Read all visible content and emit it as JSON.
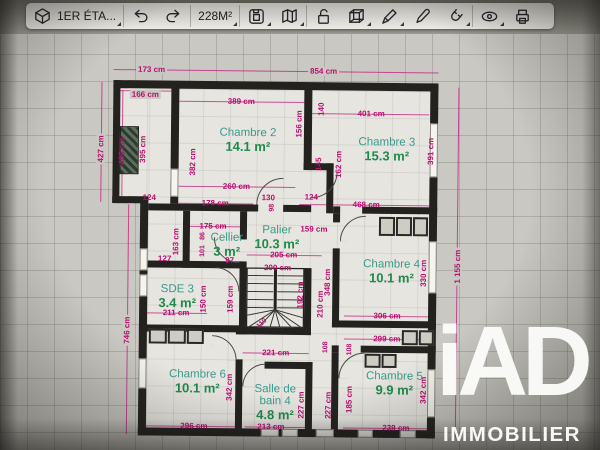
{
  "toolbar": {
    "floor_selector": {
      "label": "1ER ÉTA...",
      "icon": "floor-box-icon"
    },
    "area_button": {
      "label": "228M²"
    },
    "icons": [
      "floor-box",
      "undo-arrow",
      "redo-arrow",
      "save-document",
      "map",
      "lock-open",
      "cube-3d",
      "pencil",
      "pen",
      "magnet",
      "eye",
      "printer"
    ]
  },
  "plan": {
    "rooms": [
      {
        "name": "Chambre 2",
        "area": "14.1 m²",
        "x": 247,
        "y": 141
      },
      {
        "name": "Chambre 3",
        "area": "15.3 m²",
        "x": 386,
        "y": 149
      },
      {
        "name": "Cellier",
        "area": "3 m²",
        "x": 227,
        "y": 246
      },
      {
        "name": "Palier",
        "area": "10.3 m²",
        "x": 277,
        "y": 238
      },
      {
        "name": "Chambre 4",
        "area": "10.1 m²",
        "x": 392,
        "y": 271
      },
      {
        "name": "SDE 3",
        "area": "3.4 m²",
        "x": 178,
        "y": 298
      },
      {
        "name": "Chambre 6",
        "area": "10.1 m²",
        "x": 199,
        "y": 383
      },
      {
        "name": "Salle de",
        "name2": "bain 4",
        "area": "4.8 m²",
        "x": 277,
        "y": 403
      },
      {
        "name": "Chambre 5",
        "area": "9.9 m²",
        "x": 396,
        "y": 383
      }
    ],
    "dims": [
      {
        "t": "173 cm",
        "x": 150,
        "y": 71,
        "bg": 1
      },
      {
        "t": "854 cm",
        "x": 322,
        "y": 71,
        "bg": 1
      },
      {
        "t": "166 cm",
        "x": 144,
        "y": 96,
        "bg": 1
      },
      {
        "t": "389 cm",
        "x": 240,
        "y": 102
      },
      {
        "t": "401 cm",
        "x": 370,
        "y": 113
      },
      {
        "t": "427 cm",
        "x": 100,
        "y": 151,
        "v": 1,
        "bg": 1
      },
      {
        "t": "405 cm",
        "x": 121,
        "y": 153,
        "v": 1
      },
      {
        "t": "395 cm",
        "x": 142,
        "y": 151,
        "v": 1
      },
      {
        "t": "382 cm",
        "x": 192,
        "y": 163,
        "v": 1
      },
      {
        "t": "156 cm",
        "x": 298,
        "y": 124,
        "v": 1
      },
      {
        "t": "140",
        "x": 320,
        "y": 109,
        "v": 1
      },
      {
        "t": "145",
        "x": 318,
        "y": 164,
        "v": 1
      },
      {
        "t": "162 cm",
        "x": 338,
        "y": 164,
        "v": 1
      },
      {
        "t": "391 cm",
        "x": 430,
        "y": 150,
        "v": 1
      },
      {
        "t": "260 cm",
        "x": 236,
        "y": 187
      },
      {
        "t": "178 cm",
        "x": 215,
        "y": 204
      },
      {
        "t": "124",
        "x": 149,
        "y": 199
      },
      {
        "t": "130",
        "x": 268,
        "y": 198
      },
      {
        "t": "98",
        "x": 272,
        "y": 208,
        "v": 1,
        "s": 1
      },
      {
        "t": "124",
        "x": 311,
        "y": 197
      },
      {
        "t": "468 cm",
        "x": 366,
        "y": 204
      },
      {
        "t": "175 cm",
        "x": 213,
        "y": 227
      },
      {
        "t": "163 cm",
        "x": 176,
        "y": 243,
        "v": 1
      },
      {
        "t": "127",
        "x": 165,
        "y": 260
      },
      {
        "t": "86",
        "x": 203,
        "y": 237,
        "v": 1,
        "s": 1
      },
      {
        "t": "101",
        "x": 203,
        "y": 252,
        "v": 1,
        "s": 1
      },
      {
        "t": "97",
        "x": 230,
        "y": 261
      },
      {
        "t": "159 cm",
        "x": 314,
        "y": 229
      },
      {
        "t": "205 cm",
        "x": 284,
        "y": 255
      },
      {
        "t": "200 cm",
        "x": 278,
        "y": 268
      },
      {
        "t": "1 155 cm",
        "x": 458,
        "y": 265,
        "v": 1,
        "bg": 1
      },
      {
        "t": "348 cm",
        "x": 328,
        "y": 282,
        "v": 1
      },
      {
        "t": "210 cm",
        "x": 321,
        "y": 304,
        "v": 1
      },
      {
        "t": "192 cm",
        "x": 301,
        "y": 295,
        "v": 1
      },
      {
        "t": "159 cm",
        "x": 231,
        "y": 300,
        "v": 1
      },
      {
        "t": "150 cm",
        "x": 204,
        "y": 300,
        "v": 1
      },
      {
        "t": "211 cm",
        "x": 177,
        "y": 314
      },
      {
        "t": "306 cm",
        "x": 388,
        "y": 315
      },
      {
        "t": "299 cm",
        "x": 388,
        "y": 338
      },
      {
        "t": "330 cm",
        "x": 424,
        "y": 272,
        "v": 1
      },
      {
        "t": "221 cm",
        "x": 277,
        "y": 353
      },
      {
        "t": "108",
        "x": 327,
        "y": 347,
        "v": 1,
        "s": 1
      },
      {
        "t": "108",
        "x": 351,
        "y": 349,
        "v": 1,
        "s": 1
      },
      {
        "t": "342 cm",
        "x": 231,
        "y": 388,
        "v": 1
      },
      {
        "t": "342 cm",
        "x": 425,
        "y": 389,
        "v": 1
      },
      {
        "t": "185 cm",
        "x": 351,
        "y": 399,
        "v": 1
      },
      {
        "t": "227 cm",
        "x": 303,
        "y": 405,
        "v": 1
      },
      {
        "t": "227 cm",
        "x": 330,
        "y": 405,
        "v": 1
      },
      {
        "t": "296 cm",
        "x": 196,
        "y": 427
      },
      {
        "t": "213 cm",
        "x": 273,
        "y": 427
      },
      {
        "t": "239 cm",
        "x": 398,
        "y": 427
      },
      {
        "t": "746 cm",
        "x": 128,
        "y": 332,
        "v": 1,
        "bg": 1
      },
      {
        "t": "110",
        "x": 263,
        "y": 324,
        "d": 1,
        "s": 1
      }
    ]
  },
  "watermark": {
    "brand": "iAD",
    "subtitle": "IMMOBILIER"
  },
  "colors": {
    "dimension": "#ba0d72",
    "room_name": "#3a9a8c",
    "room_area": "#1f8a4c",
    "wall": "#23221f"
  }
}
